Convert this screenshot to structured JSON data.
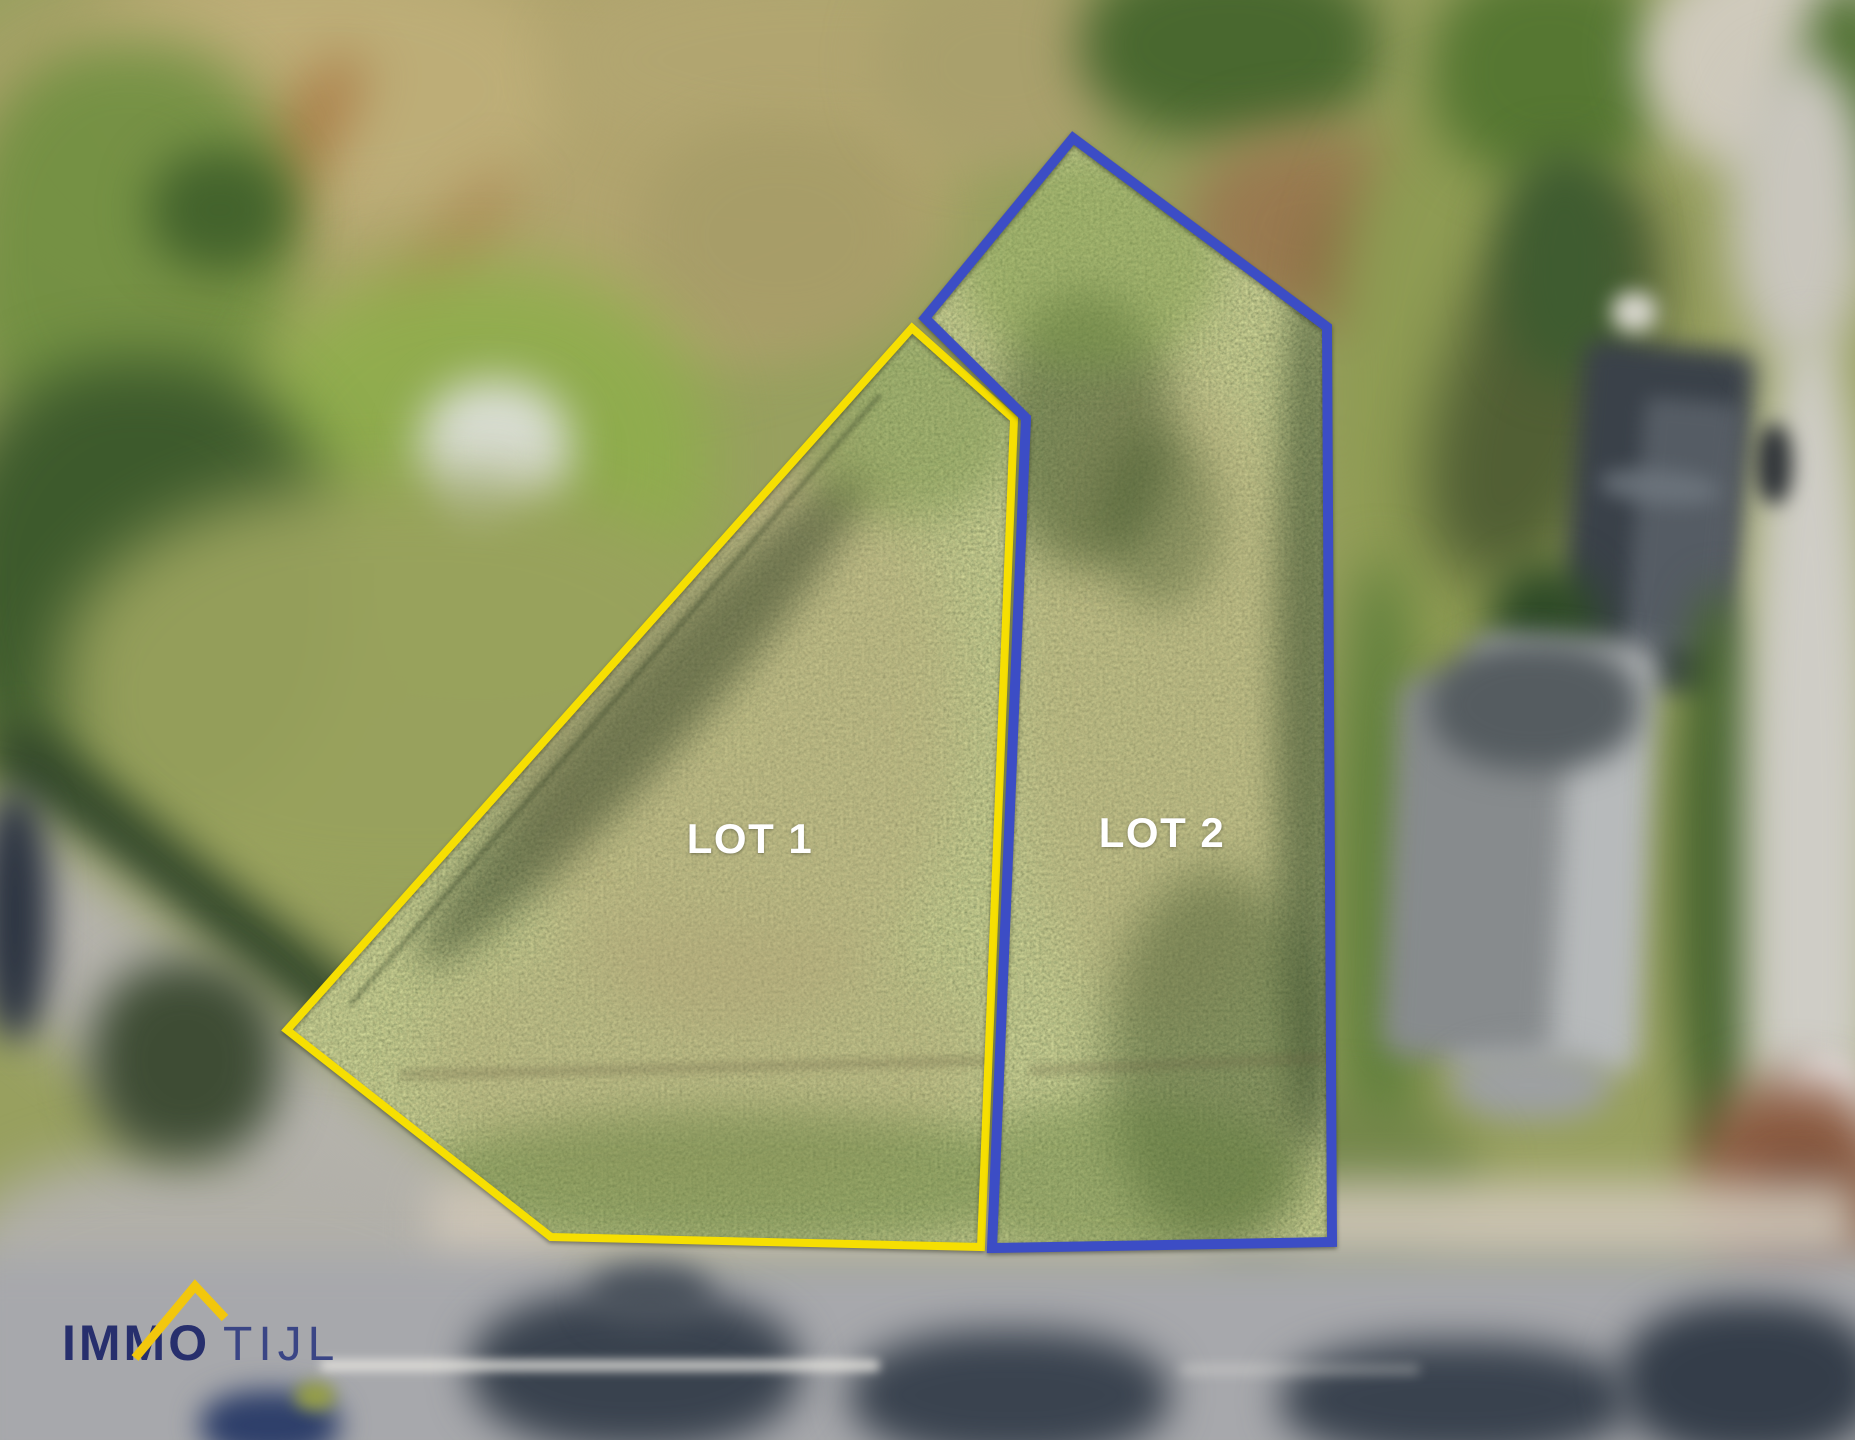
{
  "canvas": {
    "width_px": 1855,
    "height_px": 1440
  },
  "scene_type": "aerial-drone-photo-of-building-plots",
  "lots": {
    "lot1": {
      "label": "LOT 1",
      "outline_color": "#F6DF02",
      "outline_width_px": 8,
      "points": "912,328 1014,419 981,1247 551,1237 287,1030"
    },
    "lot2": {
      "label": "LOT 2",
      "outline_color": "#3C4DC5",
      "outline_width_px": 10,
      "points": "1073,138 1327,327 1332,1242 992,1248 1026,418 925,318"
    },
    "label_color": "#FFFFFF"
  },
  "branding": {
    "wordmark_primary": "IMMO",
    "wordmark_secondary": "TIJL",
    "primary_color": "#272F6D",
    "secondary_color": "#3A4585",
    "roof_icon_color": "#F2C70D",
    "roof_icon": "house-roof-icon"
  }
}
